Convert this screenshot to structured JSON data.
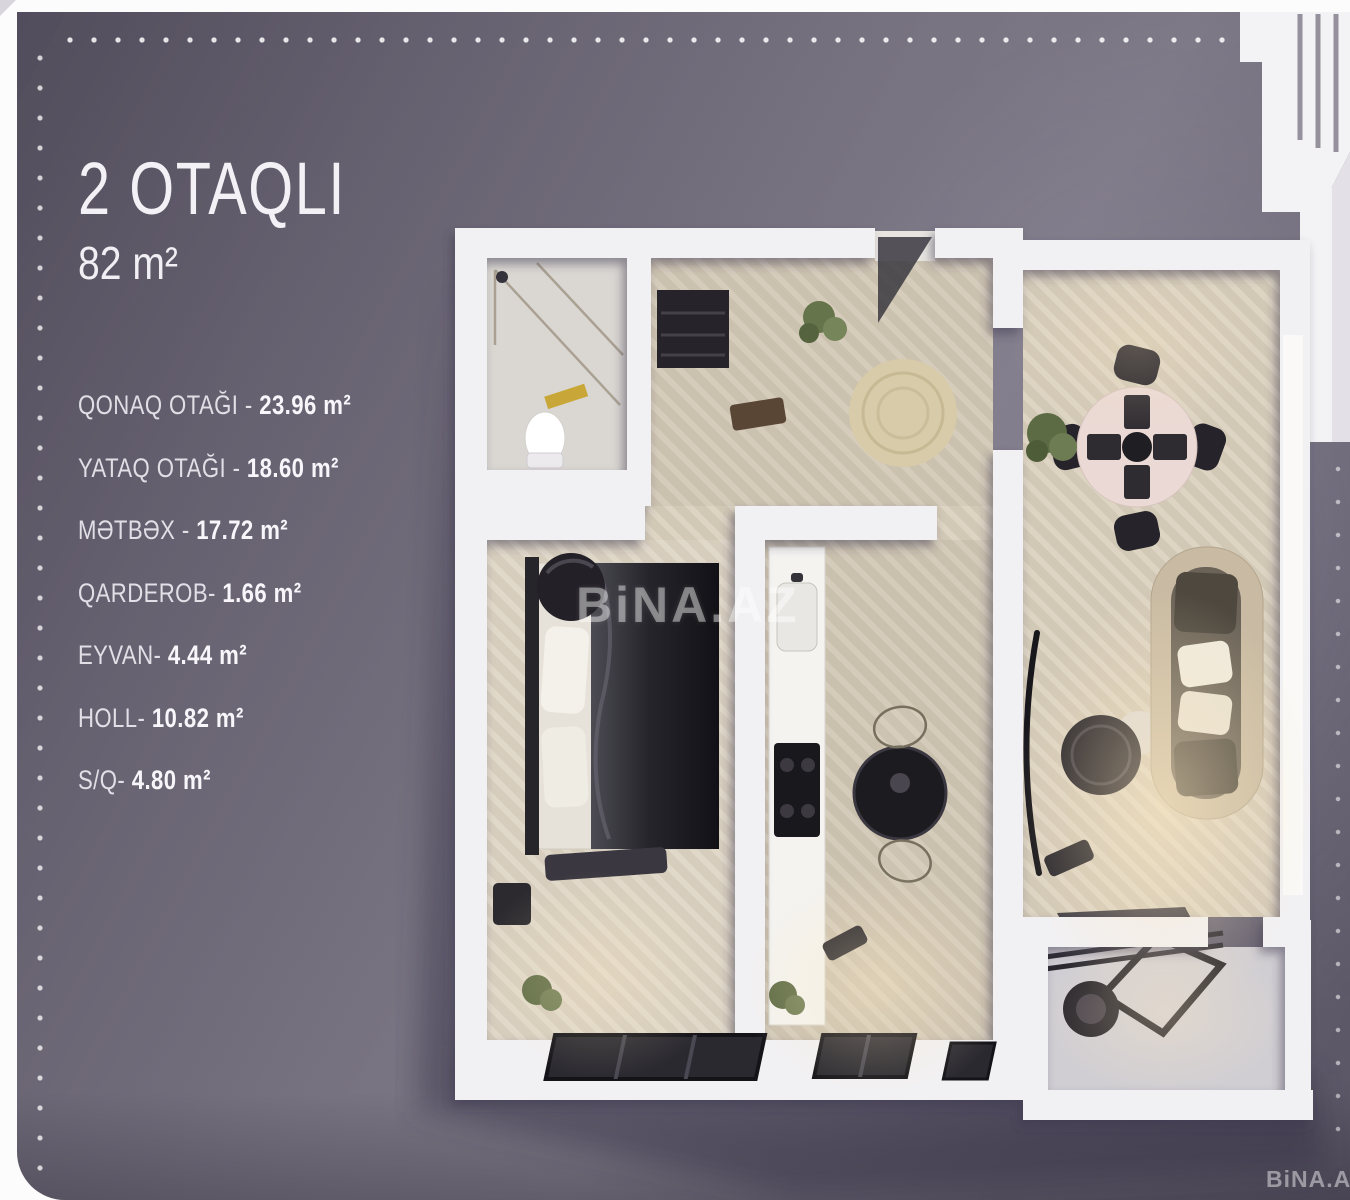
{
  "colors": {
    "page_bg": "#fcfcfd",
    "card_bg": "#6e6977",
    "text": "#f2f0f4",
    "dot": "#ffffff",
    "plan_wall": "#f1f0f3",
    "plan_wood_floor": "#d2c8b6",
    "watermark": "#ffffff"
  },
  "header": {
    "title": "2 OTAQLI",
    "area": "82 m²"
  },
  "room_list": {
    "items": [
      {
        "label": "QONAQ OTAĞI",
        "sep": " - ",
        "value": "23.96 m²"
      },
      {
        "label": "YATAQ OTAĞI",
        "sep": " - ",
        "value": "18.60 m²"
      },
      {
        "label": "MƏTBƏX",
        "sep": " - ",
        "value": "17.72 m²"
      },
      {
        "label": "QARDEROB",
        "sep": "- ",
        "value": "1.66 m²"
      },
      {
        "label": "EYVAN",
        "sep": "- ",
        "value": "4.44 m²"
      },
      {
        "label": "HOLL",
        "sep": "- ",
        "value": "10.82 m²"
      },
      {
        "label": "S/Q",
        "sep": "- ",
        "value": "4.80 m²"
      }
    ]
  },
  "watermarks": {
    "center": "BiNA.AZ",
    "corner": "BiNA.AZ"
  }
}
